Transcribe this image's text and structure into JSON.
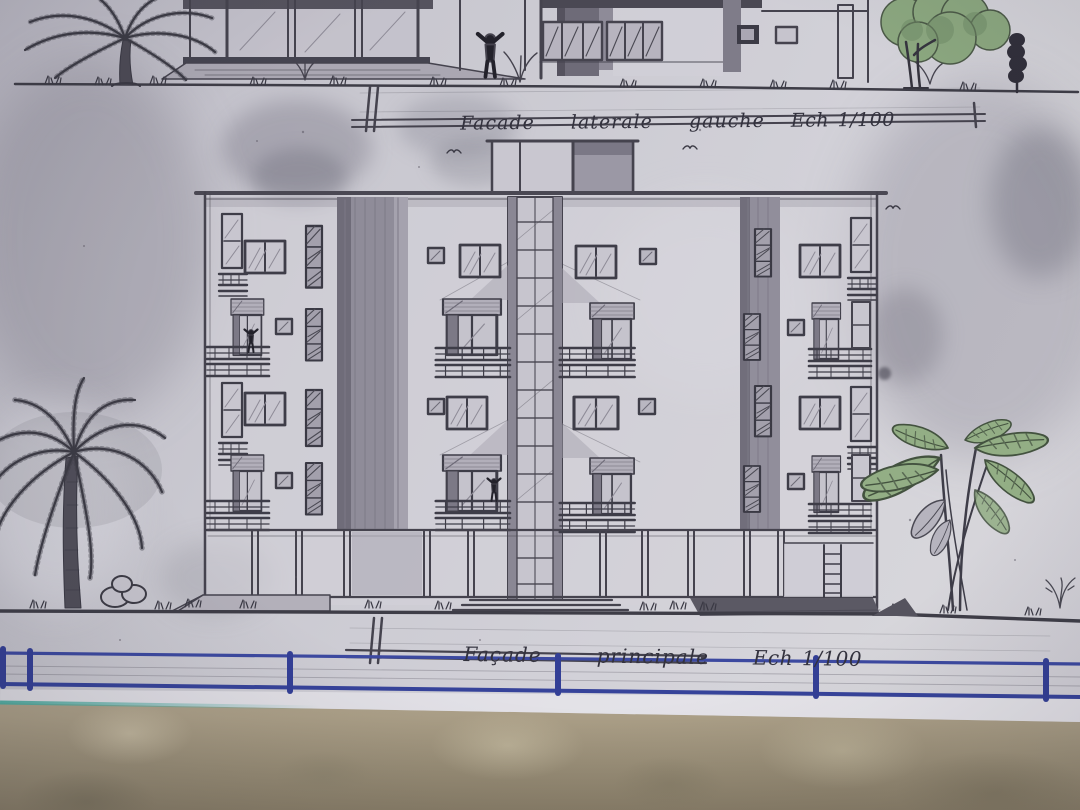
{
  "captions": {
    "top": {
      "title": "Facade  laterale  gauche",
      "scale": "Ech 1/100"
    },
    "bottom": {
      "title": "Façade   principale",
      "scale": "Ech 1/100"
    }
  },
  "colors": {
    "paper": "#cdccd4",
    "pencil": "#45434e",
    "ink_blue": "#3a47a0",
    "leaf_green": "#8ba77f",
    "floor_tan": "#b2a78e",
    "teal_edge": "#4fae9f"
  }
}
